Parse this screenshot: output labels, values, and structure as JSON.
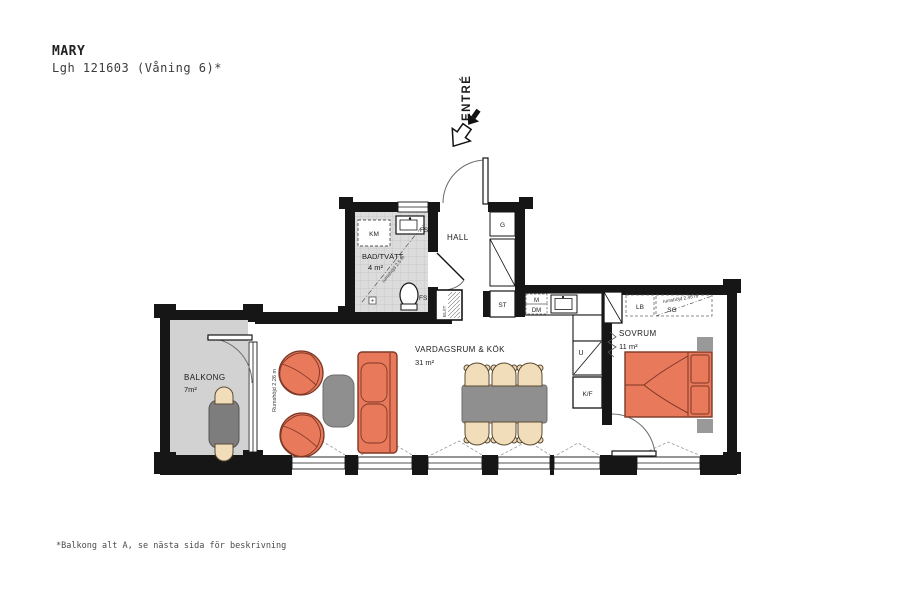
{
  "header": {
    "project_name": "MARY",
    "apartment": "Lgh 121603 (Våning 6)*"
  },
  "entry": {
    "label": "ENTRÉ"
  },
  "rooms": {
    "hall": {
      "name": "HALL"
    },
    "bathroom": {
      "name": "BAD/TVÄTT",
      "area": "4 m²",
      "ceiling_height": "rumshöjd 2.5 m"
    },
    "living_kitchen": {
      "name": "VARDAGSRUM & KÖK",
      "area": "31 m²",
      "ceiling_height": "Rumshöjd 2.26 m"
    },
    "bedroom": {
      "name": "SOVRUM",
      "area": "11 m²",
      "ceiling_height": "rumshöjd 2.45 m"
    },
    "balcony": {
      "name": "BALKONG",
      "area": "7m²"
    }
  },
  "fixtures": {
    "washer_km": "KM",
    "fs_by_sink": "FS",
    "fs_by_wc": "FS",
    "wardrobe_g": "G",
    "cleaning_st": "ST",
    "micro_m": "M",
    "dishwasher_dm": "DM",
    "oven_u": "U",
    "fridge_freezer_kf": "K/F",
    "linen_lb": "LB",
    "sliding_wardrobe_sg": "SG",
    "el_it": "EL/IT"
  },
  "footnote": {
    "text": "*Balkong alt A, se nästa sida för beskrivning"
  },
  "colors": {
    "wall": "#161616",
    "furniture_orange": "#e8795b",
    "furniture_orange_line": "#7d3826",
    "furniture_gray": "#8f8f8f",
    "chair_beige": "#f2ddba",
    "bath_floor": "#dcdcdc",
    "balcony_floor": "#d2d2d2"
  }
}
